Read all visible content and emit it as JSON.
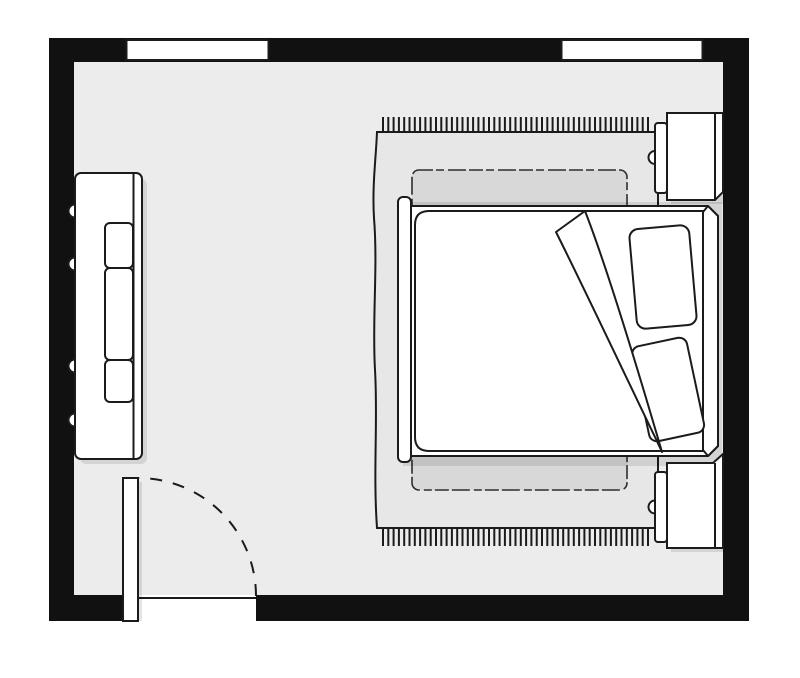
{
  "diagram": {
    "type": "floor-plan",
    "subject": "bedroom",
    "style": "black-and-white line drawing, top view"
  },
  "colors": {
    "background": "#ffffff",
    "wall": "#111111",
    "floor": "#ececec",
    "rug": "#e7e7e7",
    "rug_band": "#d8d8d8",
    "furniture": "#ffffff",
    "outline": "#1b1b1b",
    "sketch": "#2e2e2e",
    "shadow": "rgba(0,0,0,0.10)"
  },
  "elements": {
    "room": {
      "walls": "perimeter-walls",
      "windows": [
        "window-top-left",
        "window-top-right"
      ],
      "door": {
        "leaf": "door-leaf-open",
        "swing": "quarter-circle-dashed-arc",
        "location": "bottom-left-wall"
      }
    },
    "furniture": {
      "bed": {
        "parts": [
          "footboard",
          "comforter",
          "folded-comforter-corner",
          "pillow-upper",
          "pillow-lower",
          "headboard"
        ],
        "orientation": "head-against-right-wall"
      },
      "rug": {
        "parts": [
          "fringe-top",
          "fringe-bottom",
          "inner-band"
        ]
      },
      "nightstands": [
        "nightstand-top-right",
        "nightstand-bottom-right"
      ],
      "dresser": {
        "location": "left-wall",
        "parts": [
          "body",
          "inner-panel-sections",
          "wall-knobs"
        ]
      }
    }
  }
}
